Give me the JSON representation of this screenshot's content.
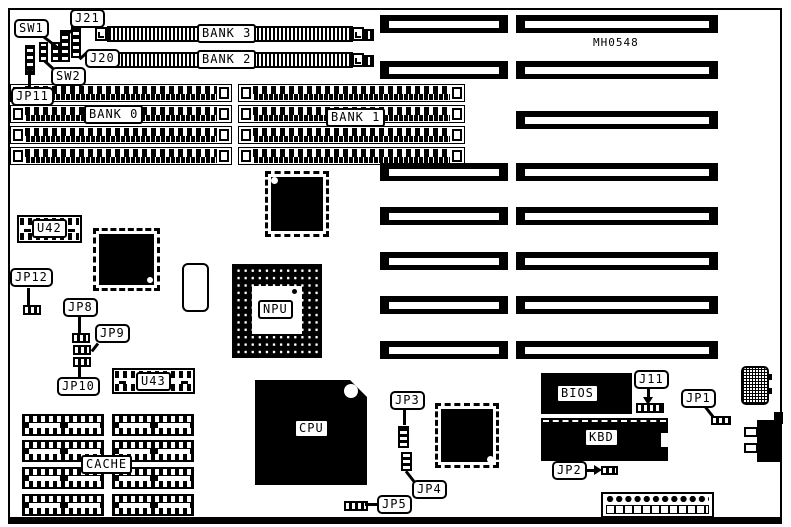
{
  "diagram": {
    "board_id": "MH0548",
    "colors": {
      "ink": "#000000",
      "paper": "#ffffff"
    },
    "labels": {
      "bank0": "BANK 0",
      "bank1": "BANK 1",
      "bank2": "BANK 2",
      "bank3": "BANK 3",
      "sw1": "SW1",
      "sw2": "SW2",
      "j20": "J20",
      "j21": "J21",
      "jp11": "JP11",
      "jp12": "JP12",
      "jp8": "JP8",
      "jp9": "JP9",
      "jp10": "JP10",
      "u42": "U42",
      "u43": "U43",
      "cache": "CACHE",
      "npu": "NPU",
      "cpu": "CPU",
      "jp3": "JP3",
      "jp4": "JP4",
      "jp5": "JP5",
      "bios": "BIOS",
      "kbd": "KBD",
      "j11": "J11",
      "jp1": "JP1",
      "jp2": "JP2"
    }
  }
}
